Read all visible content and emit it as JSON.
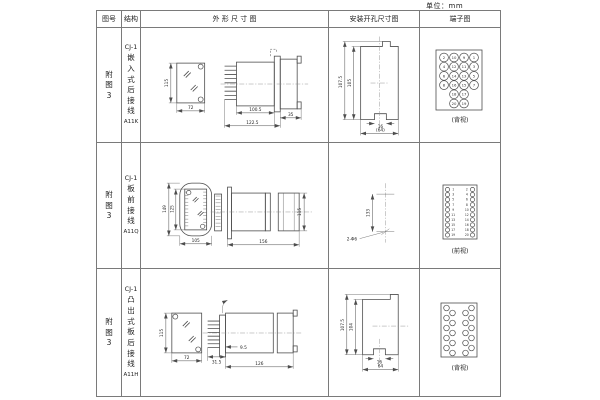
{
  "unit_label": "单位：mm",
  "table_header": {
    "figure": "图号",
    "structure": "结构",
    "outline": "外 形 尺 寸 图",
    "mounting": "安装开孔尺寸图",
    "terminal": "端子图"
  },
  "colors": {
    "line": "#4d4d4d",
    "border": "#7a7a7a",
    "text": "#222222",
    "background": "#ffffff"
  },
  "rows": [
    {
      "figure_chars": [
        "附",
        "图",
        "3"
      ],
      "structure_lines": [
        "CJ-1",
        "嵌",
        "入",
        "式",
        "后",
        "接",
        "线",
        "A11K"
      ],
      "outline": {
        "front_height": "115",
        "front_width": "72",
        "body_depth": "100.5",
        "total_depth": "122.5",
        "rear_depth": "35"
      },
      "mounting": {
        "outer_height": "107.5",
        "inner_height": "105",
        "notch_width": "16",
        "span_width": "(64)"
      },
      "terminal": {
        "view_label": "(背视)",
        "col_outer_left": [
          "2",
          "4",
          "6",
          "8"
        ],
        "col_inner_left": [
          "10",
          "12",
          "14",
          "16",
          "18",
          "20"
        ],
        "col_inner_right": [
          "9",
          "11",
          "13",
          "15",
          "17",
          "19"
        ],
        "col_outer_right": [
          "1",
          "3",
          "5",
          "7"
        ]
      }
    },
    {
      "figure_chars": [
        "附",
        "图",
        "3"
      ],
      "structure_lines": [
        "CJ-1",
        "板",
        "前",
        "接",
        "线",
        "A11Q"
      ],
      "outline": {
        "front_height": "149",
        "window_height": "125",
        "front_width": "105",
        "side_depth": "156",
        "side_height": "115"
      },
      "mounting": {
        "hole_span": "133",
        "hole_note": "2-Φ6"
      },
      "terminal": {
        "view_label": "(前视)",
        "col_left": [
          "1",
          "3",
          "5",
          "7",
          "9",
          "11",
          "13",
          "15",
          "17",
          "19"
        ],
        "col_right": [
          "2",
          "4",
          "6",
          "8",
          "10",
          "12",
          "14",
          "16",
          "18",
          "20"
        ]
      }
    },
    {
      "figure_chars": [
        "附",
        "图",
        "3"
      ],
      "structure_lines": [
        "CJ-1",
        "凸",
        "出",
        "式",
        "板",
        "后",
        "接",
        "线",
        "A11H"
      ],
      "outline": {
        "front_height": "115",
        "front_width": "72",
        "stud_depth": "31.5",
        "panel_gap": "9.5",
        "body_depth": "126"
      },
      "mounting": {
        "outer_height": "107.5",
        "inner_height": "104",
        "notch_width": "16",
        "span_width": "64"
      },
      "terminal": {
        "view_label": "(背视)"
      }
    }
  ]
}
